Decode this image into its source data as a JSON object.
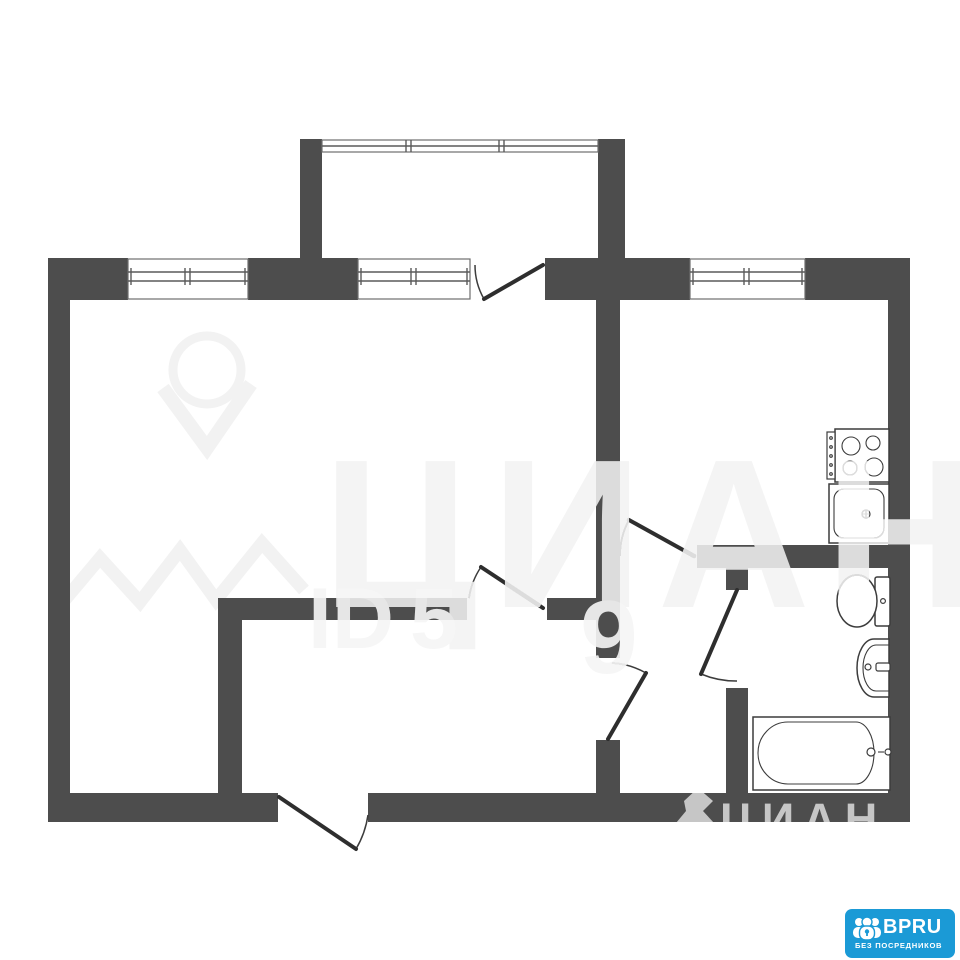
{
  "colors": {
    "wall": "#4d4d4d",
    "line": "#3c3c3c",
    "background": "#ffffff",
    "logo_blue": "#1b9ad6"
  },
  "watermark": {
    "center_brand": "ЦИАН",
    "id_label": "ID",
    "id_digit_1": "5",
    "id_digit_2": "9",
    "bottom_brand": "ЦИАН"
  },
  "logo": {
    "name": "BPRU",
    "tagline": "БЕЗ ПОСРЕДНИКОВ"
  },
  "fixtures": [
    "stove",
    "kitchen-sink",
    "toilet",
    "washbasin",
    "bathtub"
  ],
  "icons": [
    "cian-pin-icon",
    "people-lock-icon"
  ]
}
